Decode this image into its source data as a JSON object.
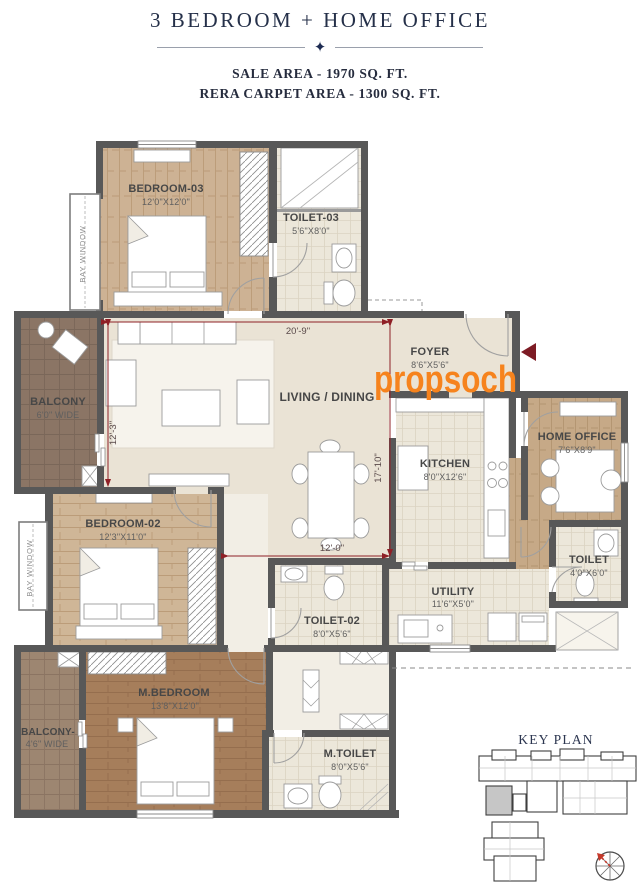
{
  "header": {
    "title": "3 BEDROOM + HOME OFFICE",
    "sale_area": "SALE AREA - 1970 SQ. FT.",
    "rera_area": "RERA CARPET AREA - 1300 SQ. FT."
  },
  "watermark": "propsoch",
  "plan": {
    "rooms": {
      "bedroom3": {
        "name": "BEDROOM-03",
        "dims": "12'0\"X12'0\""
      },
      "toilet3": {
        "name": "TOILET-03",
        "dims": "5'6\"X8'0\""
      },
      "balcony1": {
        "name": "BALCONY",
        "dims": "6'0\" WIDE"
      },
      "living": {
        "name": "LIVING / DINING"
      },
      "foyer": {
        "name": "FOYER",
        "dims": "8'6\"X5'6\""
      },
      "kitchen": {
        "name": "KITCHEN",
        "dims": "8'0\"X12'6\""
      },
      "home_office": {
        "name": "HOME OFFICE",
        "dims": "7'6\"X8'9\""
      },
      "toilet_ho": {
        "name": "TOILET",
        "dims": "4'0\"X6'0\""
      },
      "bedroom2": {
        "name": "BEDROOM-02",
        "dims": "12'3\"X11'0\""
      },
      "toilet2": {
        "name": "TOILET-02",
        "dims": "8'0\"X5'6\""
      },
      "utility": {
        "name": "UTILITY",
        "dims": "11'6\"X5'0\""
      },
      "mbedroom": {
        "name": "M.BEDROOM",
        "dims": "13'8\"X12'0\""
      },
      "balcony2": {
        "name": "BALCONY-",
        "dims": "4'6\" WIDE"
      },
      "mtoilet": {
        "name": "M.TOILET",
        "dims": "8'0\"X5'6\""
      }
    },
    "bay_window": "BAY WINDOW",
    "dims": {
      "top": "20'-9\"",
      "left": "12'-3\"",
      "right": "17'-10\"",
      "bottom": "12'-0\""
    }
  },
  "key_plan": {
    "title": "KEY PLAN"
  },
  "colors": {
    "accent_orange": "#f6831d",
    "dimension_red": "#8f2026",
    "heading_navy": "#253049",
    "wall_gray": "#585858"
  }
}
